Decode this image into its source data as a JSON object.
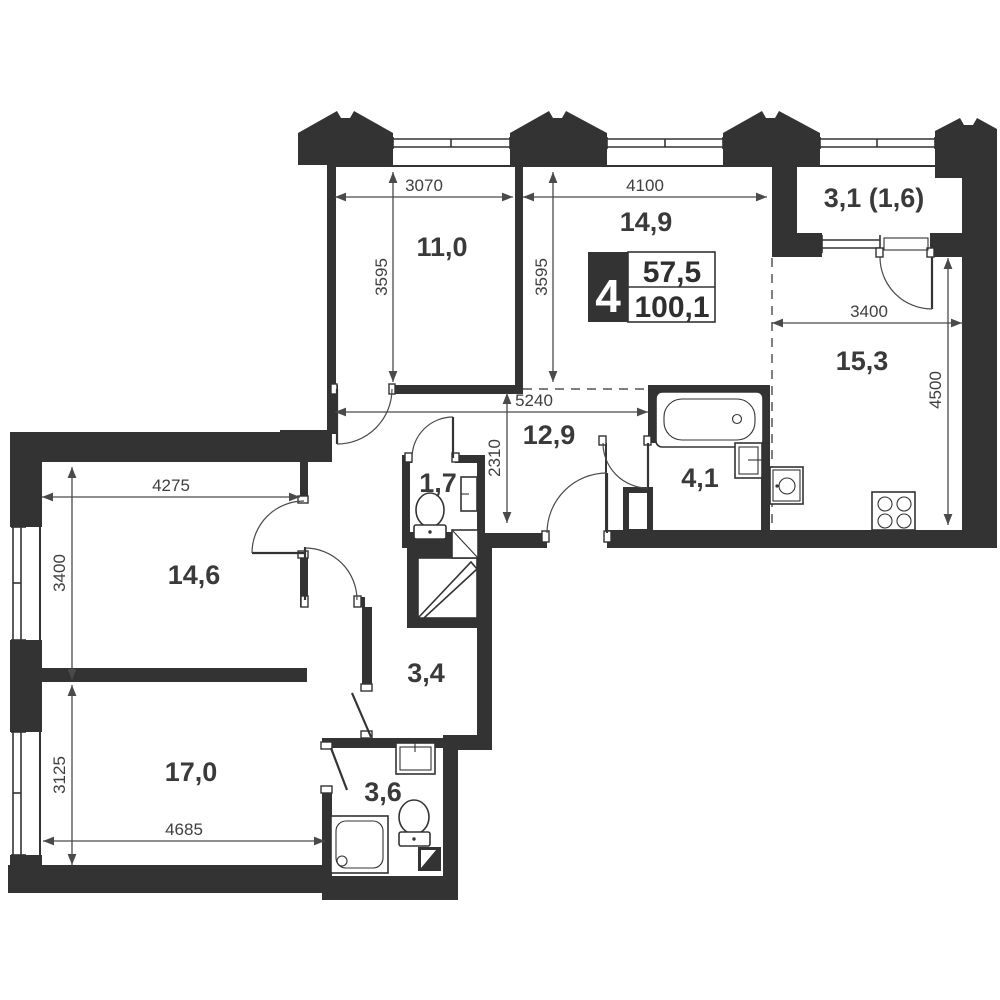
{
  "plan_info": {
    "rooms_count": "4",
    "living_area": "57,5",
    "total_area": "100,1"
  },
  "rooms": [
    {
      "name": "bedroom-top-left",
      "area": "11,0"
    },
    {
      "name": "living-zone",
      "area": "14,9"
    },
    {
      "name": "balcony",
      "area": "3,1 (1,6)"
    },
    {
      "name": "kitchen-zone",
      "area": "15,3"
    },
    {
      "name": "hallway",
      "area": "12,9"
    },
    {
      "name": "wc",
      "area": "1,7"
    },
    {
      "name": "bathroom",
      "area": "4,1"
    },
    {
      "name": "bedroom-left",
      "area": "14,6"
    },
    {
      "name": "corridor",
      "area": "3,4"
    },
    {
      "name": "bedroom-bottom",
      "area": "17,0"
    },
    {
      "name": "shower-room",
      "area": "3,6"
    }
  ],
  "dimensions": [
    {
      "value": "3070"
    },
    {
      "value": "4100"
    },
    {
      "value": "3595"
    },
    {
      "value": "3595"
    },
    {
      "value": "3400"
    },
    {
      "value": "4500"
    },
    {
      "value": "5240"
    },
    {
      "value": "2310"
    },
    {
      "value": "4275"
    },
    {
      "value": "3400"
    },
    {
      "value": "3125"
    },
    {
      "value": "4685"
    }
  ],
  "fixtures": [
    "bathtub",
    "sink",
    "washing-machine",
    "stove",
    "toilet",
    "shower",
    "wardrobe",
    "vent-duct"
  ],
  "colors": {
    "wall": "#333333",
    "text": "#3a3a3a",
    "line": "#4a4a4a",
    "background": "#ffffff"
  }
}
